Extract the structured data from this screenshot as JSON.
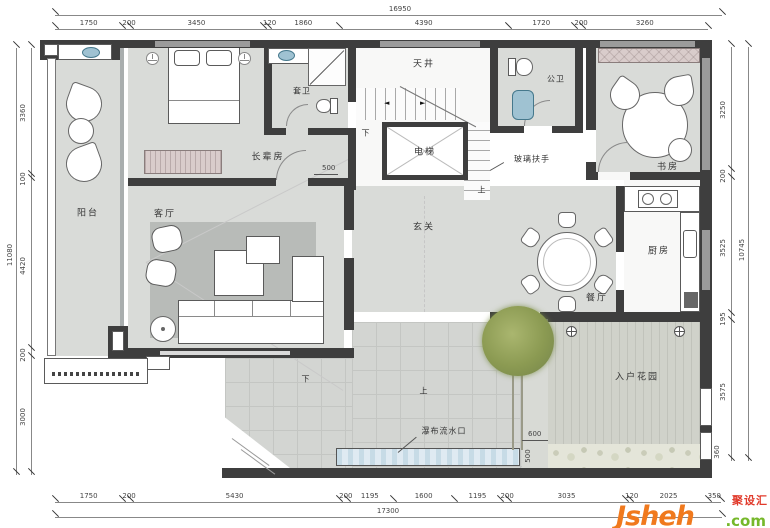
{
  "rooms": {
    "balcony": "阳台",
    "living": "客厅",
    "elder": "长辈房",
    "ensuite": "套卫",
    "lightwell": "天井",
    "elevator": "电梯",
    "public_bath": "公卫",
    "glass_rail": "玻璃扶手",
    "study": "书房",
    "foyer": "玄关",
    "kitchen": "厨房",
    "dining": "餐厅",
    "garden": "入户花园",
    "waterfall": "瀑布流水口",
    "up": "上",
    "down": "下"
  },
  "dims": {
    "top": {
      "total": "16950",
      "segments": [
        "1750",
        "200",
        "3450",
        "120",
        "1860",
        "4390",
        "1720",
        "200",
        "3260"
      ]
    },
    "left": {
      "total": "11080",
      "segments": [
        "3360",
        "100",
        "4420",
        "200",
        "3000"
      ]
    },
    "right": {
      "total": "10745",
      "segments": [
        "3250",
        "200",
        "3525",
        "195",
        "3575"
      ]
    },
    "bottom": {
      "total": "17300",
      "segments": [
        "1750",
        "200",
        "5430",
        "200",
        "1195",
        "1600",
        "1195",
        "200",
        "3035",
        "120",
        "2025",
        "350"
      ]
    },
    "inline": {
      "elder_wall": "500",
      "walkway_width": "600",
      "border_strip": "500",
      "entry_niche": "360"
    }
  },
  "watermark": {
    "brand": "Jsheh",
    "tld": ".com",
    "cn": "聚设汇"
  },
  "colors": {
    "wall": "#3e3e3e",
    "floor": "#d9dbd8",
    "rug": "#b8bbb8",
    "water": "#dfeaf2",
    "tree_green": "#8b9a52",
    "cabinet_pink": "#d9cccb",
    "basin_blue": "#9fc2d2",
    "dim_text": "#444444",
    "logo_orange": "#f0791d",
    "logo_green": "#76b82a",
    "logo_red": "#e13a2b"
  }
}
